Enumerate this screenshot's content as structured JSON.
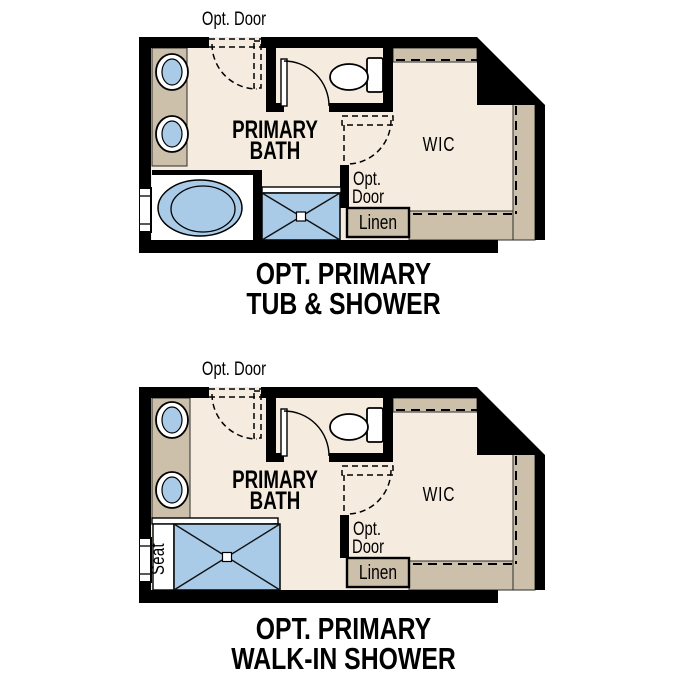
{
  "colors": {
    "wall": "#000000",
    "floor": "#f5ecdf",
    "cabinet": "#cdc0ab",
    "water": "#a9cbe7",
    "fixture_white": "#ffffff",
    "background": "#ffffff",
    "text": "#000000"
  },
  "plans": [
    {
      "name": "Opt. Primary Tub & Shower",
      "labels": {
        "opt_door_top": "Opt. Door",
        "bath_line1": "PRIMARY",
        "bath_line2": "BATH",
        "wic": "WIC",
        "opt_door_mid_line1": "Opt.",
        "opt_door_mid_line2": "Door",
        "linen": "Linen"
      },
      "title_line1": "OPT. PRIMARY",
      "title_line2": "TUB & SHOWER"
    },
    {
      "name": "Opt. Primary Walk-In Shower",
      "labels": {
        "opt_door_top": "Opt. Door",
        "bath_line1": "PRIMARY",
        "bath_line2": "BATH",
        "wic": "WIC",
        "opt_door_mid_line1": "Opt.",
        "opt_door_mid_line2": "Door",
        "linen": "Linen",
        "seat": "Seat"
      },
      "title_line1": "OPT. PRIMARY",
      "title_line2": "WALK-IN SHOWER"
    }
  ]
}
